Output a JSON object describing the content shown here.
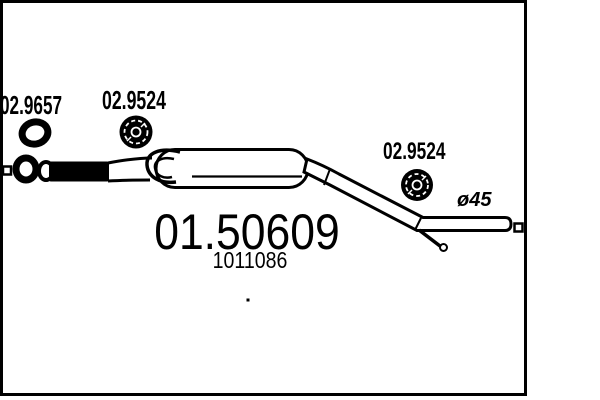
{
  "drawing": {
    "background": "#ffffff",
    "line_color": "#000000",
    "part": {
      "mts_number": "01.50609",
      "oe_number": "1011086"
    },
    "component_refs": [
      {
        "ref": "02.9657",
        "component": "gasket"
      },
      {
        "ref": "02.9524",
        "component": "rubber-mount"
      },
      {
        "ref": "02.9524",
        "component": "rubber-mount"
      }
    ],
    "pipe_diameter_label": "ø45"
  }
}
